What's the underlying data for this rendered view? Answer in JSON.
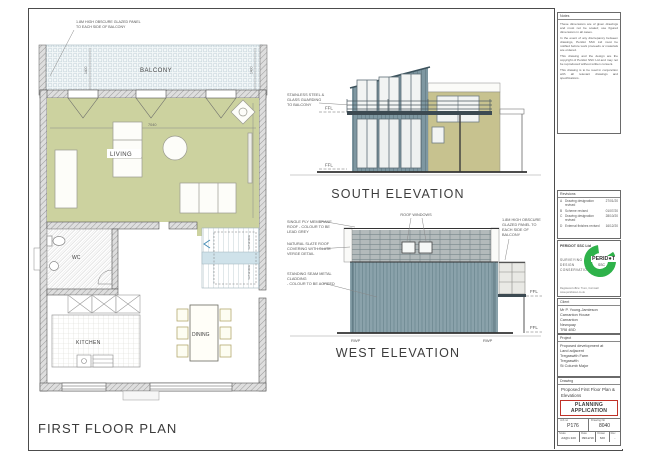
{
  "colors": {
    "olive": "#ccd29f",
    "cladding": "#7e97a1",
    "cladding2": "#8aa2ab",
    "khaki": "#c7c28f",
    "slate": "#b3babb",
    "deckbg": "#f3f7f8",
    "stairs": "#cfe2ea",
    "logo_green": "#2eb24a",
    "stamp_red": "#c03127"
  },
  "plan": {
    "title": "FIRST FLOOR PLAN",
    "balcony_label": "BALCONY",
    "living_label": "LIVING",
    "wc_label": "WC",
    "kitchen_label": "KITCHEN",
    "dining_label": "DINING",
    "note_lines": [
      "1.8M HIGH OBSCURE GLAZED PANEL",
      "TO EACH SIDE OF BALCONY"
    ],
    "dim_width": "7040",
    "dim_balcony": "1400",
    "dim_living": "4512",
    "stair_note": "roof window"
  },
  "south": {
    "title": "SOUTH ELEVATION",
    "note_lines": [
      "STAINLESS STEEL &",
      "GLASS GUARDING",
      "TO BALCONY"
    ],
    "ffl": "FFL"
  },
  "west": {
    "title": "WEST ELEVATION",
    "roof_note_lines": [
      "SINGLE PLY MEMBRANE",
      "ROOF - COLOUR TO BE",
      "LEAD GREY"
    ],
    "slate_note_lines": [
      "NATURAL SLATE ROOF",
      "COVERING WITH SLATE",
      "VERGE DETAIL"
    ],
    "cladding_note_lines": [
      "STANDING SEAM METAL",
      "CLADDING",
      "- COLOUR TO BE AGREED"
    ],
    "roof_windows_label": "ROOF WINDOWS",
    "glazed_note_lines": [
      "1.8M HIGH OBSCURE",
      "GLAZED PANEL TO",
      "EACH SIDE OF",
      "BALCONY"
    ],
    "ffl": "FFL",
    "rwp": "RWP"
  },
  "titleblock": {
    "notes": {
      "header": "Notes",
      "paragraphs": [
        "These dimensions are of given drawings and must not be scaled; use figured dimensions in all cases.",
        "In the event of any discrepancy between drawings, Peridot SSC Ltd must be notified before work proceeds or materials are ordered.",
        "This drawing and the design are the copyright of Peridot SSC Ltd and may not be reproduced without written consent.",
        "This drawing is to be read in conjunction with all relevant drawings and specifications."
      ]
    },
    "revisions": {
      "header": "Revisions",
      "rows": [
        {
          "id": "A",
          "desc": "Drawing designation revised",
          "date": "27/01/20"
        },
        {
          "id": "B",
          "desc": "Scheme revised",
          "date": "01/07/20"
        },
        {
          "id": "C",
          "desc": "Drawing designation revised",
          "date": "28/10/20"
        },
        {
          "id": "D",
          "desc": "External finishes revised",
          "date": "16/12/20"
        }
      ]
    },
    "firm": {
      "name": "PERIDOT SSC Ltd",
      "tagline_lines": [
        "SURVEYING",
        "DESIGN",
        "CONSERVATION"
      ],
      "logo_word": "PERID●T",
      "logo_sub": "SSC",
      "contact_line1": "Registered office: Truro, Cornwall",
      "contact_line2": "www.peridotssc.co.uk"
    },
    "client": {
      "header": "Client",
      "lines": [
        "Mr P. Young-Jamieson",
        "Carnanton House",
        "Carnanton",
        "Newquay",
        "TR8 4BD"
      ]
    },
    "project": {
      "header": "Project",
      "lines": [
        "Proposed development at",
        "Land adjacent",
        "Tregaswith Farm",
        "Tregaswith",
        "St Columb Major"
      ]
    },
    "drawing": {
      "header": "Drawing",
      "title": "Proposed First Floor Plan & Elevations",
      "stamp": "PLANNING APPLICATION",
      "job_no_label": "Job no",
      "job_no": "P176",
      "drawing_no_label": "Drawing No",
      "drawing_no": "8040",
      "scale_label": "Scale",
      "scale": "A3@1:100",
      "date_label": "Date",
      "date": "09/12/19",
      "drawn_label": "Drawn",
      "drawn": "MO",
      "rev_label": "Rev",
      "rev": "-"
    }
  }
}
